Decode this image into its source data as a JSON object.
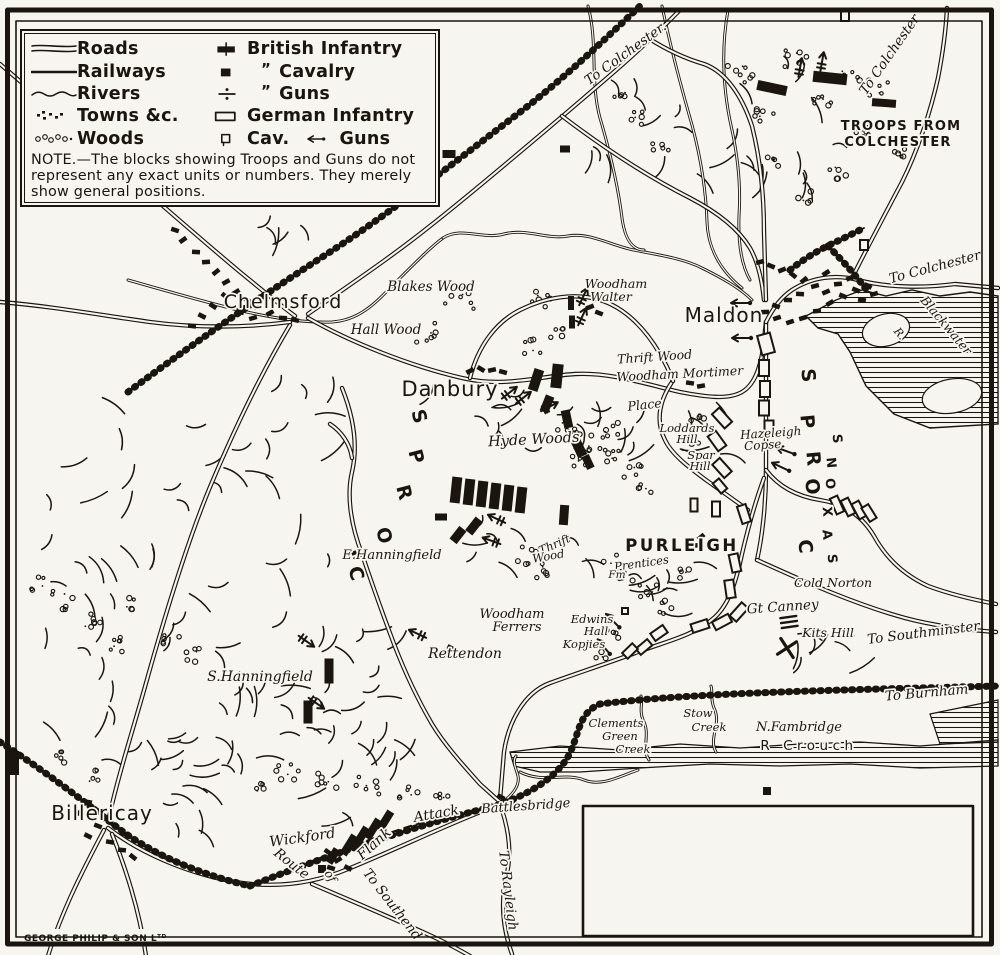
{
  "page": {
    "background": "#f7f5ef",
    "ink": "#1a150f"
  },
  "legend": {
    "terrain": [
      {
        "sym": "roads",
        "label": "Roads"
      },
      {
        "sym": "railways",
        "label": "Railways"
      },
      {
        "sym": "rivers",
        "label": "Rivers"
      },
      {
        "sym": "towns",
        "label": "Towns &c."
      },
      {
        "sym": "woods",
        "label": "Woods"
      }
    ],
    "forces": [
      {
        "sym": "british-infantry",
        "label": "British Infantry"
      },
      {
        "sym": "british-cavalry",
        "label": "Cavalry",
        "ditto": "”"
      },
      {
        "sym": "british-guns",
        "label": "Guns",
        "ditto": "”"
      },
      {
        "sym": "german-infantry",
        "label": "German Infantry"
      },
      {
        "sym": "german-cavalry",
        "label": "Cav.",
        "extra": {
          "sym": "german-guns",
          "label": "Guns"
        }
      }
    ],
    "note": "NOTE.—The blocks showing Troops and Guns do not represent any exact units or numbers.  They merely show general positions."
  },
  "credit": {
    "t": "GEORGE PHILIP & SON Lᵀᴰ",
    "x": 24,
    "y": 941,
    "s": 9
  },
  "labels": [
    {
      "t": "Chelmsford",
      "x": 283,
      "y": 308,
      "s": 19,
      "c": "town"
    },
    {
      "t": "Danbury",
      "x": 450,
      "y": 396,
      "s": 21,
      "c": "town"
    },
    {
      "t": "Maldon",
      "x": 724,
      "y": 322,
      "s": 20,
      "c": "town"
    },
    {
      "t": "Billericay",
      "x": 102,
      "y": 820,
      "s": 20,
      "c": "town"
    },
    {
      "t": "PURLEIGH",
      "x": 682,
      "y": 551,
      "s": 16.5,
      "c": "cap2"
    },
    {
      "t": "TROOPS FROM",
      "x": 901,
      "y": 130,
      "s": 13,
      "c": "cap"
    },
    {
      "t": "COLCHESTER",
      "x": 898,
      "y": 146,
      "s": 13,
      "c": "cap"
    },
    {
      "t": "Blakes Wood",
      "x": 431,
      "y": 291,
      "s": 13.5
    },
    {
      "t": "Hall Wood",
      "x": 386,
      "y": 334,
      "s": 13.5
    },
    {
      "t": "Woodham",
      "x": 616,
      "y": 288,
      "s": 12.5
    },
    {
      "t": "Walter",
      "x": 611,
      "y": 301,
      "s": 12.5
    },
    {
      "t": "Thrift Wood",
      "x": 655,
      "y": 361,
      "s": 12.5,
      "r": -4
    },
    {
      "t": "Woodham Mortimer",
      "x": 680,
      "y": 378,
      "s": 12.5,
      "r": -3
    },
    {
      "t": "Place",
      "x": 645,
      "y": 409,
      "s": 12.5,
      "r": -6
    },
    {
      "t": "Hyde Woods",
      "x": 534,
      "y": 444,
      "s": 14.5,
      "r": -3
    },
    {
      "t": "Loddards",
      "x": 687,
      "y": 432,
      "s": 11.5
    },
    {
      "t": "Hill",
      "x": 687,
      "y": 443,
      "s": 11.5
    },
    {
      "t": "Spar",
      "x": 701,
      "y": 459,
      "s": 11.5
    },
    {
      "t": "Hill",
      "x": 700,
      "y": 470,
      "s": 11.5
    },
    {
      "t": "Hazeleigh",
      "x": 771,
      "y": 437,
      "s": 12,
      "r": -4
    },
    {
      "t": "Copse",
      "x": 763,
      "y": 449,
      "s": 12,
      "r": -4
    },
    {
      "t": "Thrift",
      "x": 556,
      "y": 548,
      "s": 11.5,
      "r": -24
    },
    {
      "t": "Wood",
      "x": 549,
      "y": 560,
      "s": 11.5,
      "r": -10
    },
    {
      "t": "Prentices",
      "x": 642,
      "y": 567,
      "s": 11.5,
      "r": -8
    },
    {
      "t": "Fm",
      "x": 617,
      "y": 578,
      "s": 10.5
    },
    {
      "t": "E.Hanningfield",
      "x": 392,
      "y": 559,
      "s": 13
    },
    {
      "t": "Woodham",
      "x": 512,
      "y": 618,
      "s": 13
    },
    {
      "t": "Ferrers",
      "x": 517,
      "y": 631,
      "s": 13
    },
    {
      "t": "Edwins",
      "x": 592,
      "y": 623,
      "s": 11.5
    },
    {
      "t": "Hall",
      "x": 596,
      "y": 635,
      "s": 11.5
    },
    {
      "t": "Kopjies",
      "x": 584,
      "y": 648,
      "s": 11.5
    },
    {
      "t": "Rettendon",
      "x": 465,
      "y": 658,
      "s": 14
    },
    {
      "t": "S.Hanningfield",
      "x": 260,
      "y": 681,
      "s": 14
    },
    {
      "t": "Cold Norton",
      "x": 833,
      "y": 587,
      "s": 12.5
    },
    {
      "t": "Gt Canney",
      "x": 783,
      "y": 611,
      "s": 13.5,
      "r": -4
    },
    {
      "t": "Kits Hill",
      "x": 828,
      "y": 637,
      "s": 12.5
    },
    {
      "t": "Wickford",
      "x": 303,
      "y": 842,
      "s": 14.5,
      "r": -8
    },
    {
      "t": "Battlesbridge",
      "x": 526,
      "y": 810,
      "s": 13,
      "r": -4
    },
    {
      "t": "N.Fambridge",
      "x": 799,
      "y": 731,
      "s": 13
    },
    {
      "t": "R Crouch",
      "x": 809,
      "y": 750,
      "s": 13.5,
      "c": "sp"
    },
    {
      "t": "Stow",
      "x": 698,
      "y": 717,
      "s": 11.5
    },
    {
      "t": "Creek",
      "x": 709,
      "y": 731,
      "s": 11.5
    },
    {
      "t": "Clements",
      "x": 616,
      "y": 727,
      "s": 11.5
    },
    {
      "t": "Green",
      "x": 620,
      "y": 740,
      "s": 11.5
    },
    {
      "t": "Creek",
      "x": 633,
      "y": 753,
      "s": 11.5
    },
    {
      "t": "R.",
      "x": 897,
      "y": 336,
      "s": 11,
      "r": 50
    },
    {
      "t": "Blackwater",
      "x": 943,
      "y": 328,
      "s": 12.5,
      "r": 50
    },
    {
      "t": "To Colchester.",
      "x": 628,
      "y": 57,
      "s": 13.5,
      "r": -36
    },
    {
      "t": "To Colchester",
      "x": 893,
      "y": 57,
      "s": 13.5,
      "r": -55
    },
    {
      "t": "To Colchester",
      "x": 936,
      "y": 271,
      "s": 13.5,
      "r": -15
    },
    {
      "t": "To Southminster",
      "x": 924,
      "y": 637,
      "s": 13.5,
      "r": -7
    },
    {
      "t": "To Burnham",
      "x": 927,
      "y": 697,
      "s": 13.5,
      "r": -5
    },
    {
      "t": "To Rayleigh",
      "x": 504,
      "y": 891,
      "s": 13.5,
      "r": 83
    },
    {
      "t": "To Southend",
      "x": 389,
      "y": 907,
      "s": 13.5,
      "r": 52
    },
    {
      "t": "Route",
      "x": 289,
      "y": 867,
      "s": 13.5,
      "r": 38
    },
    {
      "t": "of",
      "x": 327,
      "y": 878,
      "s": 12,
      "r": 60
    },
    {
      "t": "Flank",
      "x": 377,
      "y": 847,
      "s": 14,
      "r": -42
    },
    {
      "t": "Attack",
      "x": 437,
      "y": 818,
      "s": 14,
      "r": -10
    }
  ],
  "corps": [
    {
      "word": "CORPS",
      "size": 19,
      "rot": 75,
      "letters": [
        [
          350,
          575
        ],
        [
          378,
          537
        ],
        [
          398,
          494
        ],
        [
          410,
          458
        ],
        [
          413,
          418
        ]
      ]
    },
    {
      "word": "CORPS",
      "size": 19,
      "rot": 85,
      "letters": [
        [
          799,
          547
        ],
        [
          806,
          487
        ],
        [
          807,
          459
        ],
        [
          801,
          422
        ],
        [
          802,
          376
        ]
      ]
    },
    {
      "word": "SAXONS",
      "size": 13,
      "rot": 85,
      "letters": [
        [
          828,
          559
        ],
        [
          823,
          535
        ],
        [
          823,
          512
        ],
        [
          826,
          484
        ],
        [
          827,
          463
        ],
        [
          833,
          439
        ]
      ]
    }
  ],
  "units": {
    "british_infantry": [
      [
        772,
        88,
        30,
        10,
        12
      ],
      [
        830,
        78,
        34,
        11,
        6
      ],
      [
        884,
        103,
        24,
        8,
        4
      ],
      [
        536,
        380,
        10,
        22,
        18
      ],
      [
        557,
        376,
        11,
        24,
        6
      ],
      [
        547,
        404,
        9,
        17,
        22
      ],
      [
        567,
        419,
        9,
        18,
        -12
      ],
      [
        579,
        448,
        10,
        18,
        -25
      ],
      [
        588,
        462,
        8,
        14,
        -25
      ],
      [
        571,
        303,
        6,
        14,
        0
      ],
      [
        572,
        322,
        6,
        13,
        0
      ],
      [
        456,
        490,
        10,
        26,
        6
      ],
      [
        469,
        492,
        10,
        26,
        6
      ],
      [
        482,
        494,
        10,
        26,
        6
      ],
      [
        495,
        496,
        10,
        26,
        6
      ],
      [
        508,
        498,
        10,
        26,
        6
      ],
      [
        521,
        500,
        10,
        26,
        6
      ],
      [
        474,
        526,
        9,
        17,
        38
      ],
      [
        458,
        535,
        9,
        16,
        38
      ],
      [
        441,
        517,
        12,
        7,
        0
      ],
      [
        564,
        515,
        9,
        20,
        4
      ],
      [
        329,
        671,
        9,
        25,
        0
      ],
      [
        308,
        712,
        9,
        23,
        0
      ],
      [
        349,
        845,
        8,
        22,
        32
      ],
      [
        361,
        837,
        8,
        22,
        32
      ],
      [
        373,
        829,
        8,
        22,
        32
      ],
      [
        385,
        821,
        8,
        22,
        32
      ],
      [
        333,
        856,
        8,
        16,
        32
      ],
      [
        14,
        763,
        10,
        24,
        0
      ]
    ],
    "british_cavalry": [
      [
        449,
        154,
        13,
        8,
        0
      ],
      [
        565,
        149,
        10,
        7,
        0
      ],
      [
        322,
        869,
        8,
        8,
        0
      ],
      [
        767,
        791,
        8,
        8,
        0
      ]
    ],
    "german_infantry": [
      [
        766,
        344,
        13,
        20,
        -15
      ],
      [
        764,
        368,
        10,
        16,
        0
      ],
      [
        765,
        389,
        10,
        16,
        0
      ],
      [
        764,
        408,
        10,
        15,
        0
      ],
      [
        769,
        427,
        9,
        13,
        0
      ],
      [
        722,
        418,
        10,
        19,
        -42
      ],
      [
        717,
        441,
        10,
        18,
        -36
      ],
      [
        722,
        468,
        10,
        18,
        -42
      ],
      [
        720,
        486,
        8,
        13,
        -40
      ],
      [
        694,
        505,
        7,
        13,
        0
      ],
      [
        716,
        509,
        8,
        15,
        0
      ],
      [
        837,
        505,
        8,
        17,
        -24
      ],
      [
        848,
        507,
        8,
        17,
        -26
      ],
      [
        859,
        510,
        8,
        17,
        -28
      ],
      [
        869,
        513,
        8,
        16,
        -32
      ],
      [
        744,
        514,
        9,
        18,
        -18
      ],
      [
        735,
        563,
        9,
        18,
        -12
      ],
      [
        730,
        589,
        9,
        18,
        -8
      ],
      [
        739,
        612,
        9,
        18,
        42
      ],
      [
        722,
        622,
        9,
        18,
        62
      ],
      [
        700,
        626,
        9,
        17,
        72
      ],
      [
        659,
        633,
        9,
        15,
        55
      ],
      [
        644,
        647,
        8,
        15,
        50
      ],
      [
        630,
        651,
        8,
        14,
        46
      ],
      [
        625,
        611,
        6,
        6,
        0
      ]
    ],
    "german_cavalry": [
      [
        864,
        245,
        8,
        10,
        0
      ],
      [
        845,
        16,
        8,
        10,
        0
      ]
    ],
    "british_guns": [
      [
        800,
        68,
        -80
      ],
      [
        822,
        62,
        -80
      ],
      [
        583,
        297,
        -65
      ],
      [
        582,
        317,
        -65
      ],
      [
        509,
        393,
        -38
      ],
      [
        523,
        398,
        -38
      ],
      [
        549,
        407,
        -28
      ],
      [
        497,
        519,
        205
      ],
      [
        492,
        541,
        200
      ],
      [
        306,
        641,
        35
      ],
      [
        316,
        703,
        35
      ],
      [
        418,
        634,
        205
      ]
    ],
    "german_guns": [
      [
        741,
        303,
        180
      ],
      [
        742,
        338,
        180
      ],
      [
        786,
        451,
        200
      ],
      [
        781,
        467,
        205
      ],
      [
        613,
        621,
        225
      ],
      [
        604,
        647,
        230
      ]
    ]
  },
  "marks": {
    "x_mark": {
      "x": 787,
      "y": 648,
      "rot": 12
    },
    "battery_bars": {
      "x": 789,
      "y": 622,
      "rot": -8
    }
  }
}
